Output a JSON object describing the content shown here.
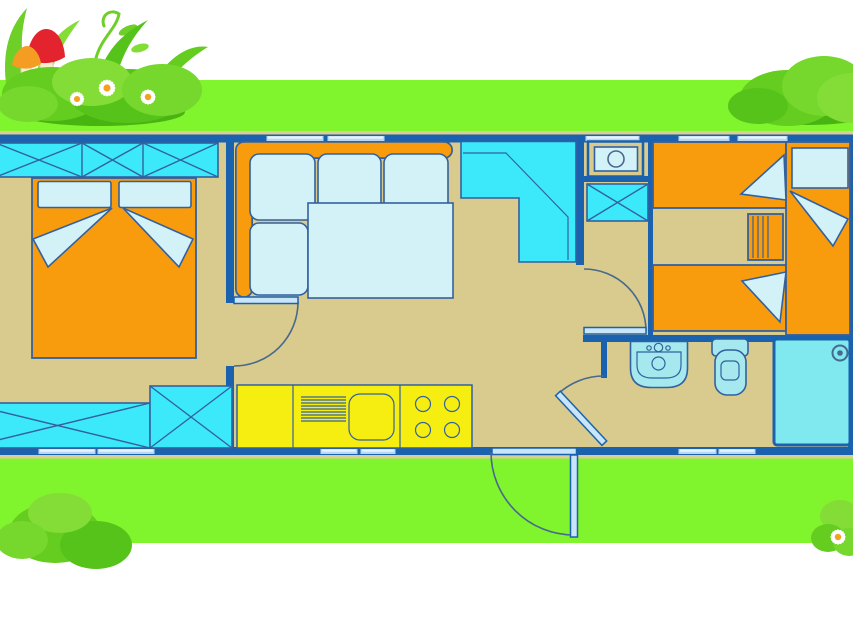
{
  "meta": {
    "kind": "floor-plan-illustration",
    "canvas": {
      "width": 853,
      "height": 619
    }
  },
  "colors": {
    "bg": "#ffffff",
    "grass": "#80f42c",
    "trim": "#d9ce96",
    "floor": "#d8cb8d",
    "wall": "#1a62ae",
    "line": "#33619f",
    "arc": "#47688f",
    "cyan": "#3ce9fa",
    "pale": "#d3f2f8",
    "orange": "#f89c0e",
    "yellow": "#f6ee10",
    "window": "#b5d9f6",
    "window_lite": "#e9f4fd",
    "door": "#c8e5fa",
    "fixture": "#a5e9ee",
    "shower": "#7fe9ef",
    "bush_dark": "#48b412",
    "bush_mid": "#64cd20",
    "bush_deep": "#55c319",
    "bush_light": "#84dd37",
    "bush_soft": "#76d72c",
    "leaf": "#6ecf28",
    "mushroom_red": "#e3232e",
    "mushroom_orange": "#f59d22",
    "mushroom_stem": "#f4eecb",
    "daisy_petal": "#ffffff",
    "daisy_center": "#f5a01e"
  },
  "scene": {
    "decorations": [
      {
        "name": "bush-cluster-top-left",
        "elements": [
          "grass-blades",
          "curly-vine",
          "red-mushroom",
          "orange-mushroom",
          "bush",
          "daisy-flowers-x3"
        ]
      },
      {
        "name": "bush-top-right",
        "elements": [
          "bush"
        ]
      },
      {
        "name": "bush-bottom-left",
        "elements": [
          "bush"
        ]
      },
      {
        "name": "bush-bottom-right",
        "elements": [
          "bush",
          "daisy-flower"
        ]
      }
    ],
    "rooms": [
      {
        "name": "double-bedroom",
        "furniture": [
          "x-wardrobe-top",
          "double-bed",
          "pillow-left",
          "pillow-right",
          "blanket-folds",
          "x-bench-bottom",
          "x-wardrobe-bottom"
        ]
      },
      {
        "name": "living-area",
        "furniture": [
          "corner-sofa",
          "seat-cushions-x4",
          "table",
          "corner-cabinet"
        ]
      },
      {
        "name": "kitchen",
        "furniture": [
          "counter",
          "drainer",
          "sink-basin",
          "hob-4-burners"
        ]
      },
      {
        "name": "utility-column",
        "furniture": [
          "boiler-unit",
          "x-shelf"
        ]
      },
      {
        "name": "twin-bedroom",
        "furniture": [
          "single-bed-top",
          "single-bed-bottom",
          "single-bed-right",
          "pillow",
          "blanket-wedges",
          "drawer-chest"
        ]
      },
      {
        "name": "bathroom",
        "furniture": [
          "washbasin",
          "toilet",
          "shower-cabin"
        ]
      }
    ],
    "doors": [
      {
        "name": "door-double-bedroom",
        "swing": "quarter-arc"
      },
      {
        "name": "door-twin-bedroom",
        "swing": "quarter-arc"
      },
      {
        "name": "door-bathroom",
        "swing": "quarter-arc"
      },
      {
        "name": "door-entrance",
        "swing": "quarter-arc-outside"
      }
    ],
    "window_count": 11
  }
}
